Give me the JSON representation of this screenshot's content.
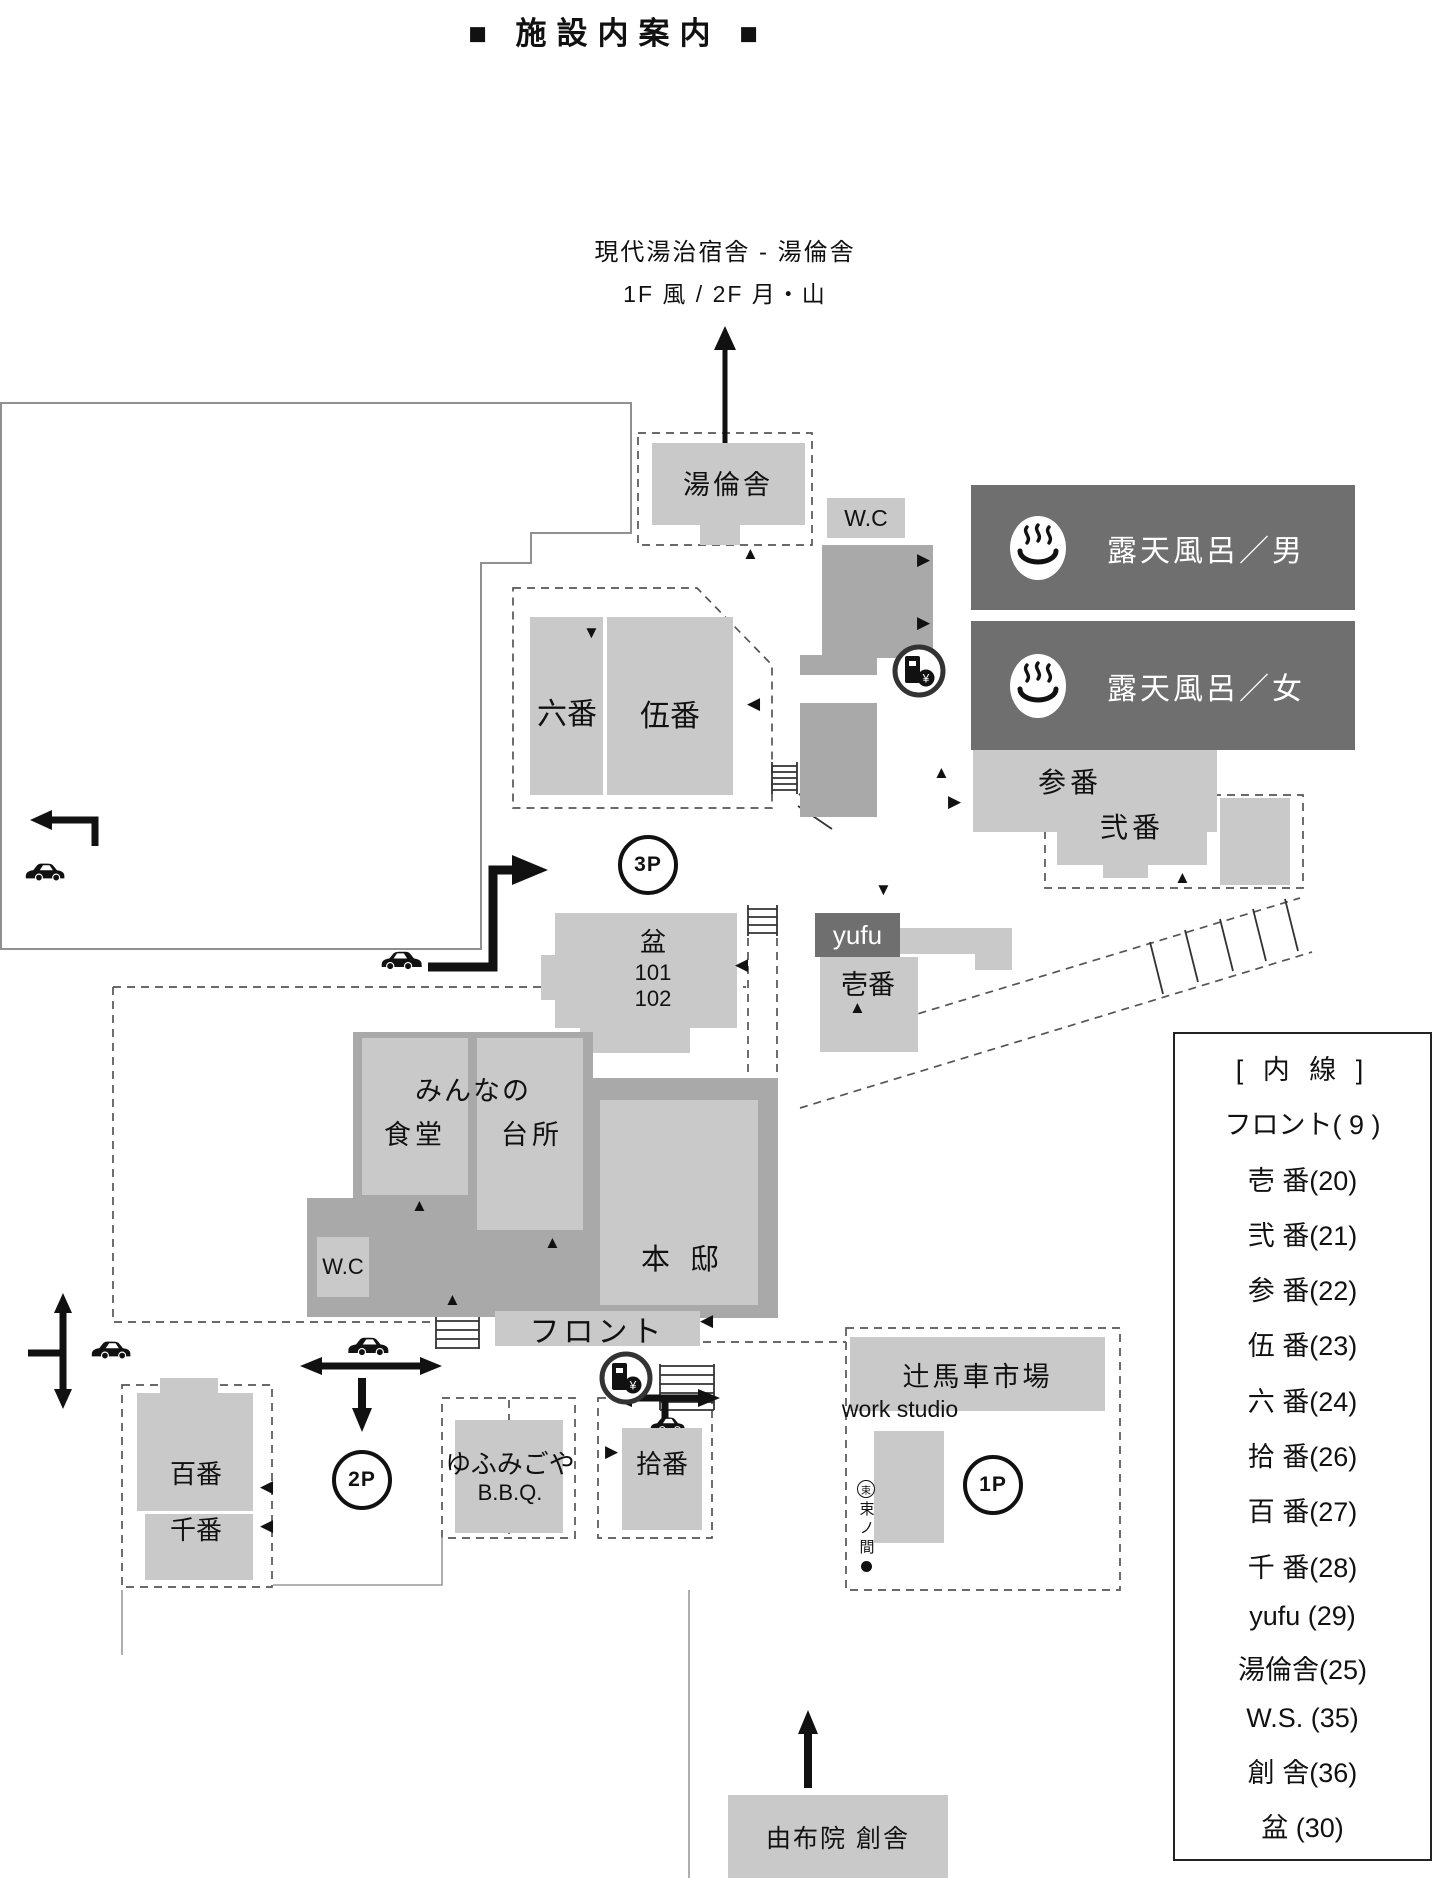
{
  "title": "■ 施設内案内 ■",
  "annotation": {
    "line1": "現代湯治宿舎 - 湯倫舎",
    "line2": "1F 風 / 2F 月・山"
  },
  "logo": {
    "mark": "束",
    "romaji": "tsukanoma",
    "name": "束ノ間",
    "subtitle": "YUFUIN RELAXATION LOCATION",
    "location": "由布院温泉"
  },
  "map": {
    "yurinsha": "湯倫舎",
    "wc": "W.C",
    "bath_men": "露天風呂／男",
    "bath_women": "露天風呂／女",
    "sanban": "参番",
    "niban": "弐番",
    "rokuban": "六番",
    "goban": "伍番",
    "bon": "盆",
    "bon_101": "101",
    "bon_102": "102",
    "yufu": "yufu",
    "ichiban": "壱番",
    "minnano": "みんなの",
    "shokudo": "食堂",
    "daidokoro": "台所",
    "hontei": "本 邸",
    "front": "フロント",
    "hyakuban": "百番",
    "senban": "千番",
    "yufumigoya": "ゆふみごや",
    "bbq": "B.B.Q.",
    "juban": "拾番",
    "tsujibasha": "辻馬車市場",
    "work_studio": "work studio",
    "sosha": "由布院 創舎",
    "mini_sign": "束ノ間"
  },
  "parking": {
    "p1": "1P",
    "p2": "2P",
    "p3": "3P"
  },
  "legend": {
    "title": "[ 内 線 ]",
    "entries": [
      "フロント( 9 )",
      "壱 番(20)",
      "弐 番(21)",
      "参 番(22)",
      "伍 番(23)",
      "六 番(24)",
      "拾 番(26)",
      "百 番(27)",
      "千 番(28)",
      "yufu (29)",
      "湯倫舎(25)",
      "W.S. (35)",
      "創 舎(36)",
      "盆 (30)"
    ]
  },
  "icons": {
    "up": "▲",
    "down": "▼",
    "left": "◀",
    "right": "▶",
    "yen": "¥"
  },
  "colors": {
    "building_light": "#c9c9c9",
    "building_mid": "#a9a9a9",
    "banner_dark": "#6f6f6f"
  }
}
